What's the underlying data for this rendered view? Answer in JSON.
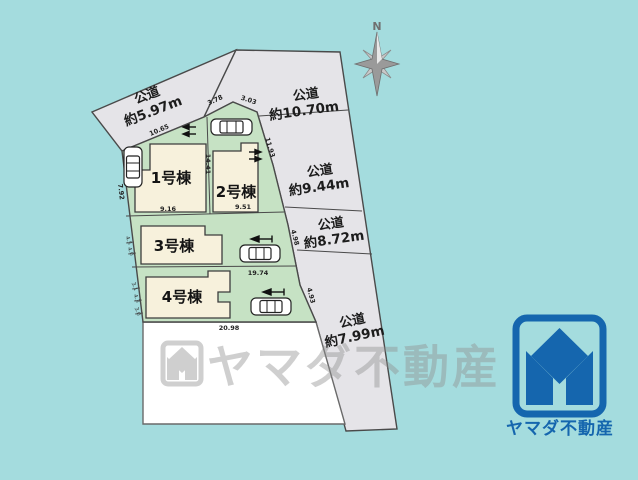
{
  "colors": {
    "background": "#a4dcde",
    "road_fill": "#e5e4e8",
    "plot_green": "#c6e2c4",
    "building_cream": "#f7f1dc",
    "logo_blue": "#1566ae",
    "watermark_gray": "#8f8f8f"
  },
  "compass": {
    "label": "N"
  },
  "roads": [
    {
      "name": "公道",
      "size": "約5.97m"
    },
    {
      "name": "公道",
      "size": "約10.70m"
    },
    {
      "name": "公道",
      "size": "約9.44m"
    },
    {
      "name": "公道",
      "size": "約8.72m"
    },
    {
      "name": "公道",
      "size": "約7.99m"
    }
  ],
  "plots": [
    {
      "building": "1号棟"
    },
    {
      "building": "2号棟"
    },
    {
      "building": "3号棟"
    },
    {
      "building": "4号棟"
    }
  ],
  "dimensions": {
    "plot1_top": "10.65",
    "plot1_left": "7.92",
    "plot2_top_left": "3.78",
    "plot2_top_right": "3.03",
    "plot2_right": "11.93",
    "boundary_1_2": "14.41",
    "mid_left": "9.16",
    "mid_right": "9.51",
    "plot3_4_boundary": "19.74",
    "plot4_bottom": "20.98",
    "edge_plot3_right": "4.98",
    "edge_plot4_right": "4.93",
    "tick_a": "4.5",
    "tick_b": "4.0",
    "tick_c": "3.1",
    "tick_d": "4.3",
    "tick_e": "3.0"
  },
  "watermark": {
    "text": "ヤマダ不動産"
  },
  "logo": {
    "text": "ヤマダ不動産"
  }
}
